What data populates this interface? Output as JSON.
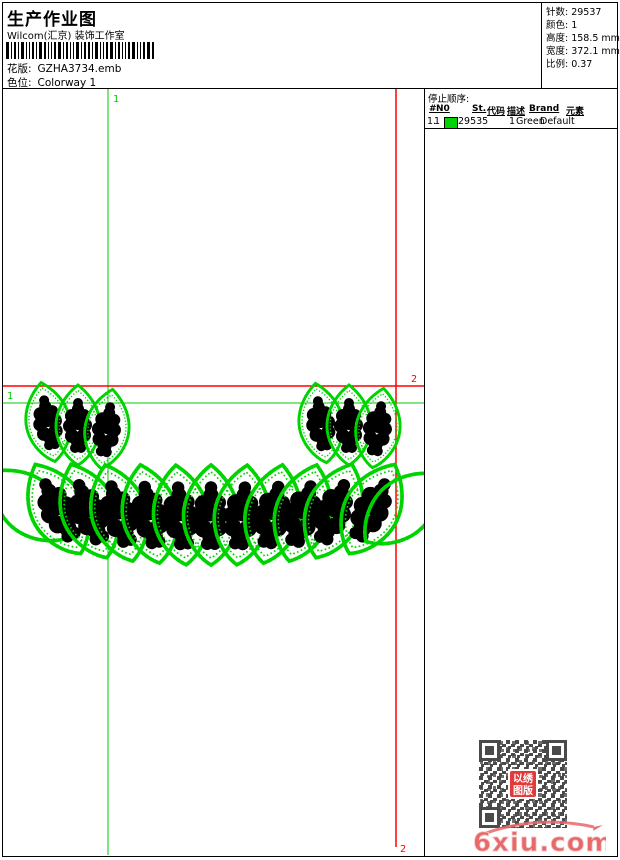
{
  "header": {
    "title": "生产作业图",
    "subtitle": "Wilcom(汇京) 装饰工作室",
    "design_label": "花版:",
    "design_value": "GZHA3734.emb",
    "colorway_label": "色位:",
    "colorway_value": "Colorway 1"
  },
  "info": {
    "rows": [
      {
        "label": "针数:",
        "value": "29537"
      },
      {
        "label": "颜色:",
        "value": "1"
      },
      {
        "label": "高度:",
        "value": "158.5 mm"
      },
      {
        "label": "宽度:",
        "value": "372.1 mm"
      },
      {
        "label": "比例:",
        "value": "0.37"
      }
    ]
  },
  "stop_sequence": {
    "title": "停止顺序:",
    "columns": [
      "#",
      "N0",
      "St.",
      "代码",
      "描述",
      "Brand",
      "元素"
    ],
    "rows": [
      {
        "num": "1.",
        "n0": "1",
        "swatch_color": "#00d400",
        "st": "29535",
        "code": "1",
        "desc": "Green",
        "brand": "Default",
        "element": ""
      }
    ]
  },
  "canvas": {
    "marker1": "1",
    "marker2": "2"
  },
  "watermark": {
    "logo_text": "6xiu.com",
    "stamp_line1": "以绣",
    "stamp_line2": "图版"
  },
  "colors": {
    "design_green": "#00d400",
    "guide_green": "#00c800",
    "guide_red": "#ff0000",
    "qr_dark": "#4a4a4a",
    "stamp_red": "#e23a3a",
    "logo_red": "#e8696a",
    "logo_red_light": "#f5c0c0"
  }
}
